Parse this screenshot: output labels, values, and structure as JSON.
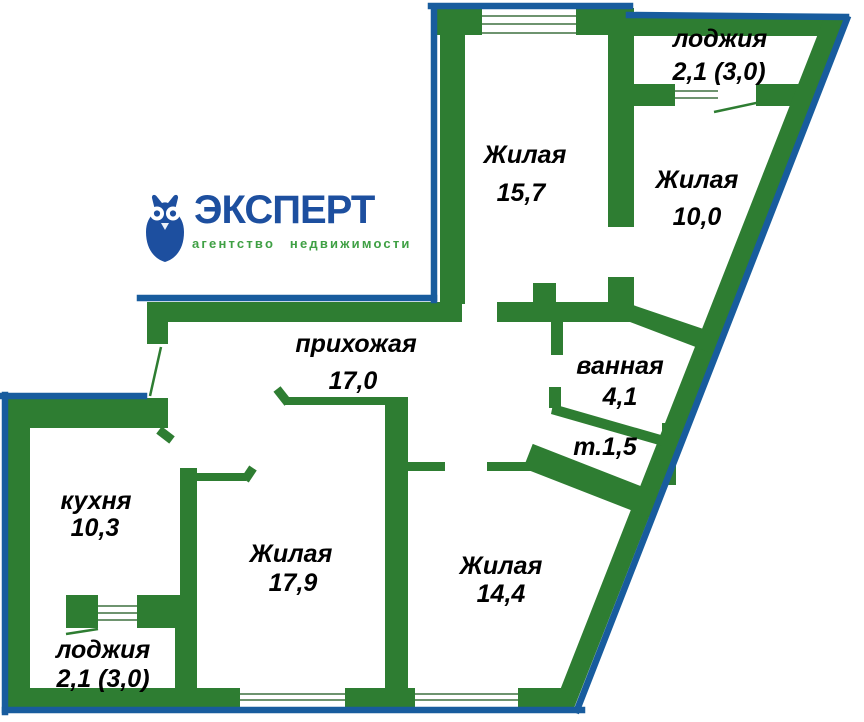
{
  "logo": {
    "brand": "ЭКСПЕРТ",
    "tagline": "агентство недвижимости",
    "icon": "owl-icon"
  },
  "colors": {
    "background": "#ffffff",
    "wall_green": "#2e7d32",
    "outline_blue": "#185c9e",
    "logo_blue": "#1d4f9f",
    "logo_green": "#3fa044",
    "label_text": "#000000",
    "window_line": "#6e946f"
  },
  "floor_plan": {
    "rooms": [
      {
        "id": "living-1",
        "name": "Жилая",
        "area": "15,7"
      },
      {
        "id": "loggia-top",
        "name": "лоджия",
        "area": "2,1 (3,0)"
      },
      {
        "id": "living-2",
        "name": "Жилая",
        "area": "10,0"
      },
      {
        "id": "hallway",
        "name": "прихожая",
        "area": "17,0"
      },
      {
        "id": "bathroom",
        "name": "ванная",
        "area": "4,1"
      },
      {
        "id": "toilet",
        "name": "т.1,5",
        "area": ""
      },
      {
        "id": "kitchen",
        "name": "кухня",
        "area": "10,3"
      },
      {
        "id": "living-3",
        "name": "Жилая",
        "area": "17,9"
      },
      {
        "id": "living-4",
        "name": "Жилая",
        "area": "14,4"
      },
      {
        "id": "loggia-bottom",
        "name": "лоджия",
        "area": "2,1 (3,0)"
      }
    ]
  }
}
